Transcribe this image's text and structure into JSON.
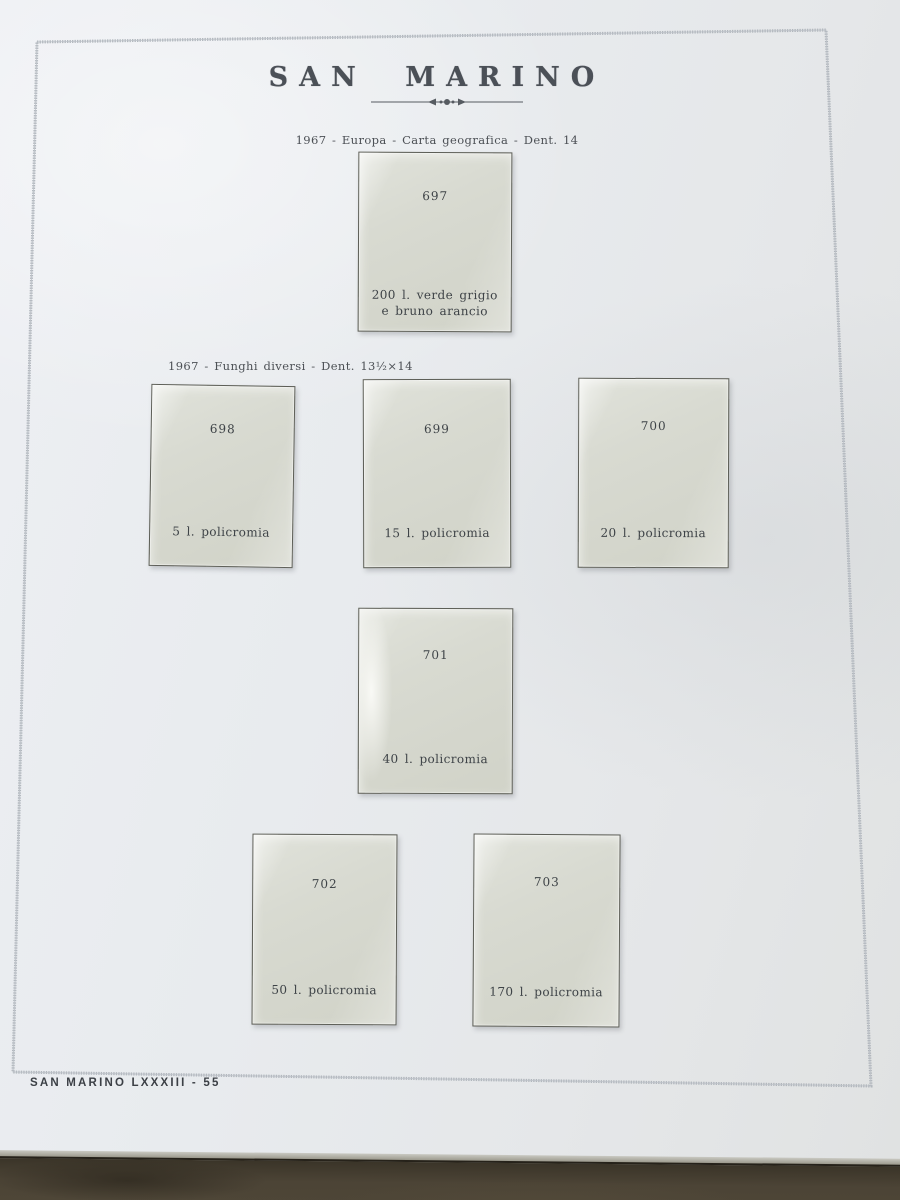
{
  "album_page": {
    "title": "SAN MARINO",
    "footer": "SAN MARINO LXXXIII - 55",
    "sections": {
      "europa": {
        "caption": "1967 - Europa - Carta geografica - Dent. 14"
      },
      "funghi": {
        "caption": "1967 - Funghi diversi - Dent. 13½×14"
      }
    },
    "mounts": {
      "m697": {
        "number": "697",
        "label_line1": "200 l. verde grigio",
        "label_line2": "e bruno arancio"
      },
      "m698": {
        "number": "698",
        "label": "5 l. policromia"
      },
      "m699": {
        "number": "699",
        "label": "15 l. policromia"
      },
      "m700": {
        "number": "700",
        "label": "20 l. policromia"
      },
      "m701": {
        "number": "701",
        "label": "40 l. policromia"
      },
      "m702": {
        "number": "702",
        "label": "50 l. policromia"
      },
      "m703": {
        "number": "703",
        "label": "170 l. policromia"
      }
    },
    "icons": {
      "divider_ornament": "arrow-dot-divider-icon"
    },
    "colors": {
      "paper": "#e8ebee",
      "mount": "#d6d8cf",
      "ink": "#3e4347",
      "frame": "#9aa0a8",
      "desk": "#4a4336"
    }
  }
}
